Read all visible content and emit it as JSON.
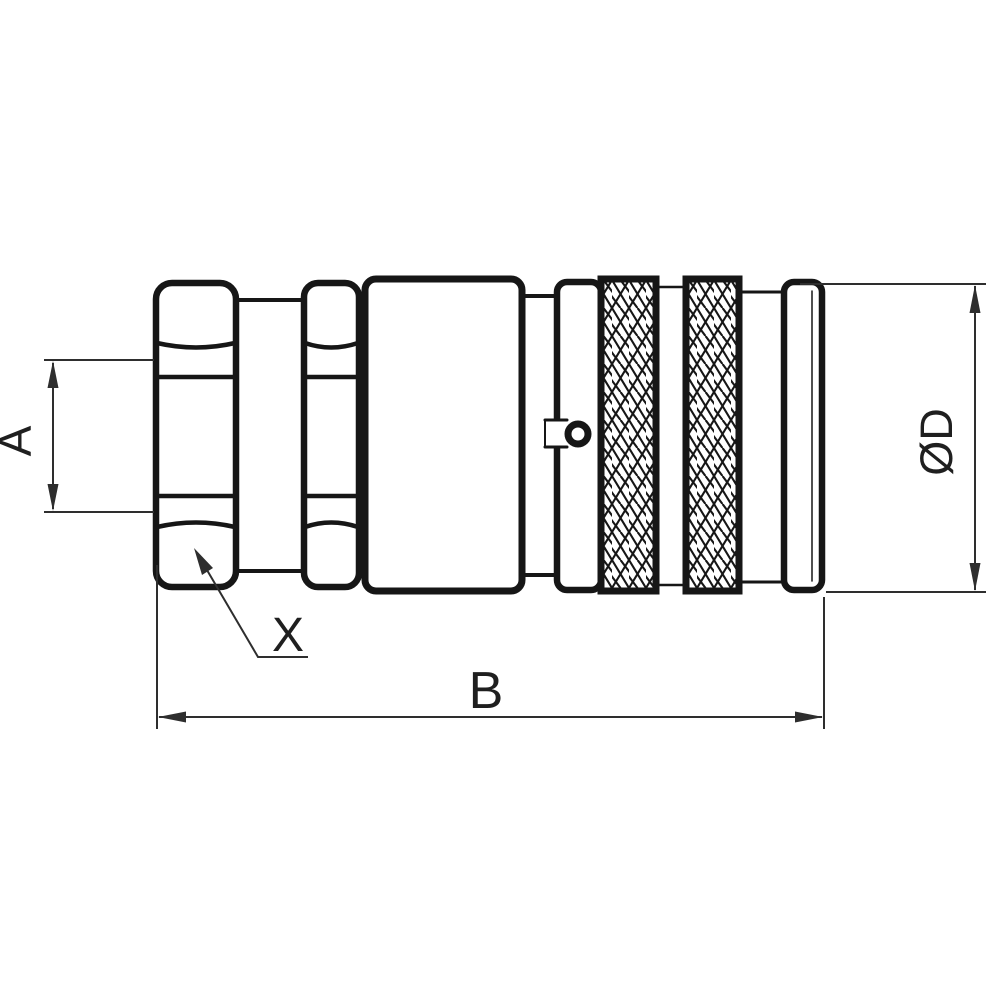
{
  "drawing": {
    "kind": "technical-line-drawing",
    "subject": "quick-release hydraulic coupling, side view",
    "colors": {
      "background": "#ffffff",
      "outline": "#161616",
      "dimension": "#2e2e2e"
    },
    "labels": {
      "a": "A",
      "b": "B",
      "d": "ØD",
      "x": "X"
    }
  }
}
